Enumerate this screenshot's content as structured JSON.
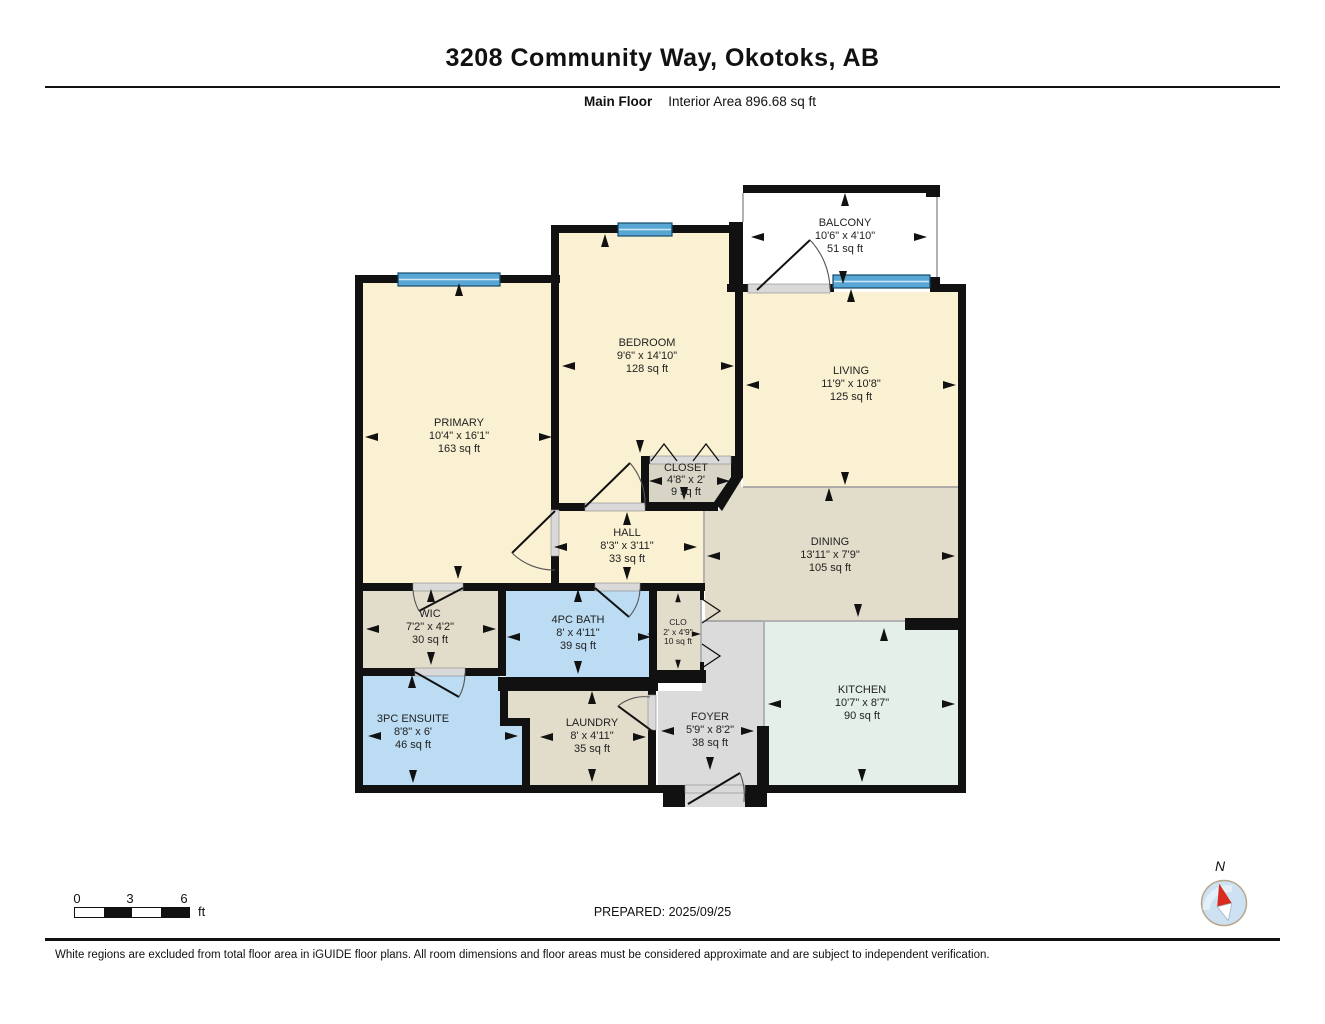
{
  "header": {
    "title": "3208 Community Way, Okotoks, AB",
    "floor_label": "Main Floor",
    "area_label": "Interior Area 896.68 sq ft"
  },
  "rooms": [
    {
      "name": "PRIMARY",
      "dims": "10'4\" x 16'1\"",
      "area": "163 sq ft"
    },
    {
      "name": "BEDROOM",
      "dims": "9'6\" x 14'10\"",
      "area": "128 sq ft"
    },
    {
      "name": "LIVING",
      "dims": "11'9\" x 10'8\"",
      "area": "125 sq ft"
    },
    {
      "name": "BALCONY",
      "dims": "10'6\" x 4'10\"",
      "area": "51 sq ft"
    },
    {
      "name": "CLOSET",
      "dims": "4'8\" x 2'",
      "area": "9 sq ft"
    },
    {
      "name": "HALL",
      "dims": "8'3\" x 3'11\"",
      "area": "33 sq ft"
    },
    {
      "name": "DINING",
      "dims": "13'11\" x 7'9\"",
      "area": "105 sq ft"
    },
    {
      "name": "WIC",
      "dims": "7'2\" x 4'2\"",
      "area": "30 sq ft"
    },
    {
      "name": "4PC BATH",
      "dims": "8' x 4'11\"",
      "area": "39 sq ft"
    },
    {
      "name": "CLO",
      "dims": "2' x 4'9\"",
      "area": "10 sq ft"
    },
    {
      "name": "KITCHEN",
      "dims": "10'7\" x 8'7\"",
      "area": "90 sq ft"
    },
    {
      "name": "3PC ENSUITE",
      "dims": "8'8\" x 6'",
      "area": "46 sq ft"
    },
    {
      "name": "LAUNDRY",
      "dims": "8' x 4'11\"",
      "area": "35 sq ft"
    },
    {
      "name": "FOYER",
      "dims": "5'9\" x 8'2\"",
      "area": "38 sq ft"
    }
  ],
  "footer": {
    "scale": {
      "tick0": "0",
      "tick1": "3",
      "tick2": "6",
      "unit": "ft"
    },
    "prepared": "PREPARED: 2025/09/25",
    "compass_label": "N",
    "disclaimer": "White regions are excluded from total floor area in iGUIDE floor plans. All room dimensions and floor areas must be considered approximate and are subject to independent verification."
  },
  "colors": {
    "room_cream": "#FAF1D2",
    "room_beige": "#E2DCCA",
    "room_closet": "#D9D5C6",
    "room_blue": "#BBDCF2",
    "room_mint": "#E3EFE8",
    "room_grey": "#DBDBDB",
    "window_blue": "#58A6D4",
    "wall": "#111111"
  }
}
